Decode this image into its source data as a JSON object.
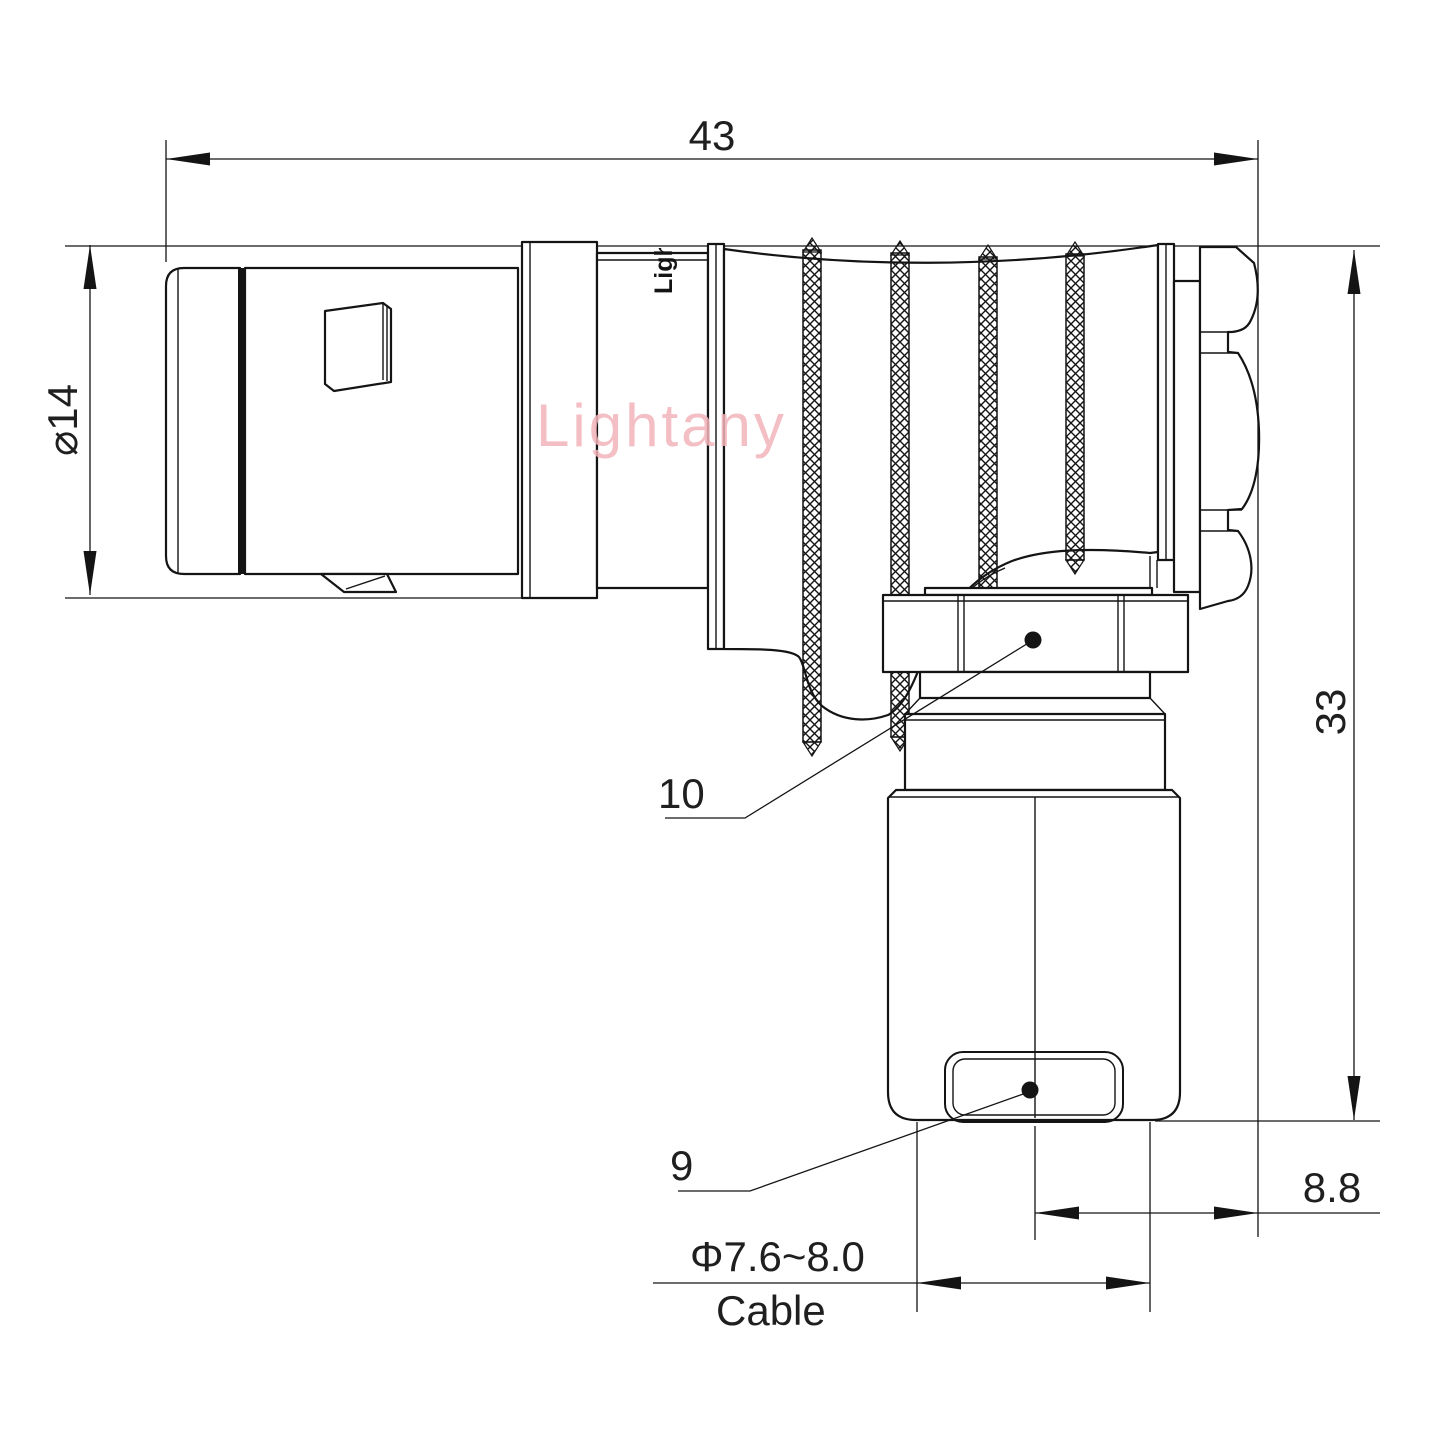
{
  "drawing": {
    "line_color": "#141414",
    "watermark": {
      "text": "Lightany",
      "color": "#f3b5ba"
    },
    "part_marking": {
      "text": "Lightany"
    },
    "dimensions": {
      "overall_length": "43",
      "front_diameter": "⌀14",
      "overall_height": "33",
      "rear_offset": "8.8",
      "cable_diameter": "Φ7.6~8.0",
      "cable_label": "Cable"
    },
    "callouts": {
      "coupling_nut": "10",
      "cable_clamp": "9"
    }
  }
}
